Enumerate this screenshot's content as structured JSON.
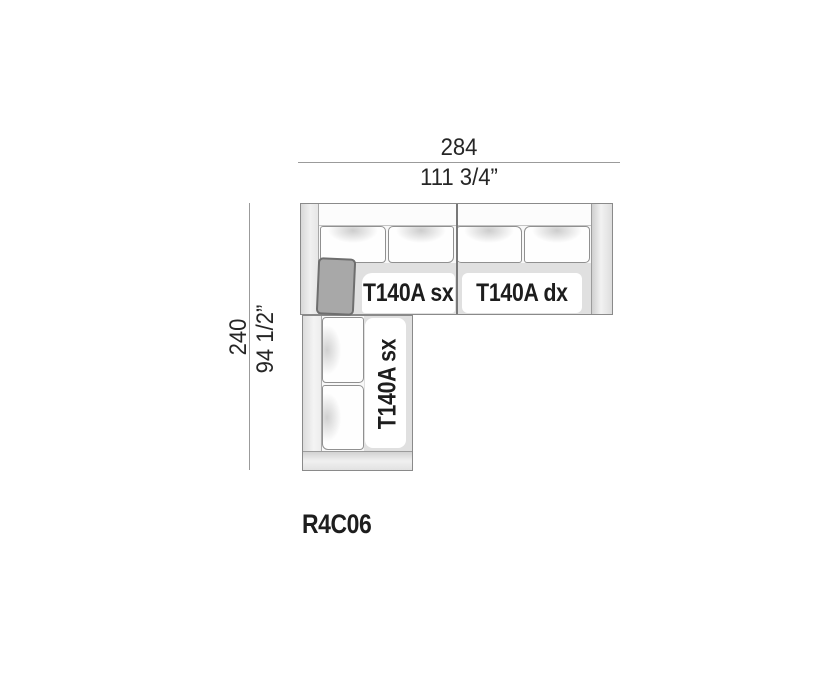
{
  "diagram": {
    "model_code": "R4C06",
    "dimensions": {
      "width": {
        "value_cm": "284",
        "value_in": "111 3/4”"
      },
      "depth": {
        "value_cm": "240",
        "value_in": "94 1/2”"
      }
    },
    "modules": {
      "top_left": {
        "label": "T140A sx"
      },
      "top_right": {
        "label": "T140A dx"
      },
      "left_column": {
        "label": "T140A sx"
      }
    },
    "cushions": {
      "back_cushions_top_row": 4,
      "back_cushions_left_column": 2,
      "accent_pillows": 1
    },
    "colors": {
      "background": "#ffffff",
      "outline": "#8a8a8a",
      "dimension_line": "#9b9b9b",
      "dimension_text": "#262626",
      "label_text": "#1d1d1d",
      "accent_pillow": "#a8a8a8",
      "armrest_fill": "#dedede",
      "seat_shadow": "#e0e0e0"
    }
  }
}
